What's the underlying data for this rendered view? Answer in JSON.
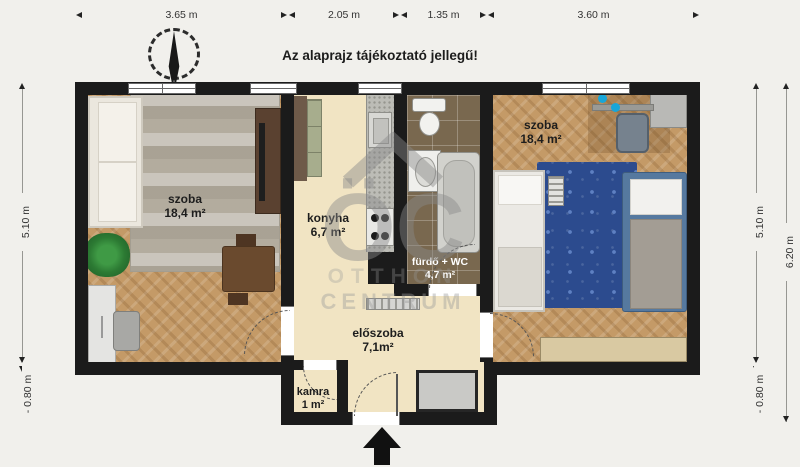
{
  "title": "Az alaprajz tájékoztató jellegű!",
  "dimensions": {
    "top": [
      {
        "label": "3.65 m"
      },
      {
        "label": "2.05 m"
      },
      {
        "label": "1.35 m"
      },
      {
        "label": "3.60 m"
      }
    ],
    "left": {
      "height": "5.10 m",
      "offset": "- 0.80 m"
    },
    "right_inner": {
      "height": "5.10 m",
      "offset": "- 0.80 m"
    },
    "right_outer": {
      "height": "6.20 m"
    }
  },
  "rooms": {
    "living_room": {
      "name": "szoba",
      "area": "18,4 m²"
    },
    "kitchen": {
      "name": "konyha",
      "area": "6,7 m²"
    },
    "bathroom": {
      "name": "fürdő + WC",
      "area": "4,7 m²"
    },
    "bedroom": {
      "name": "szoba",
      "area": "18,4 m²"
    },
    "hallway": {
      "name": "előszoba",
      "area": "7,1m²"
    },
    "pantry": {
      "name": "kamra",
      "area": "1 m²"
    }
  },
  "watermark": {
    "monogram": "ÖC",
    "line1": "OTTHON",
    "line2": "CENTRUM"
  },
  "icons": [
    "north-arrow-icon",
    "entrance-arrow-icon"
  ],
  "colors": {
    "background": "#f1f0ec",
    "wall": "#1b1b1b",
    "wood_floor": "#c49a67",
    "cream_floor": "#f1e4c3",
    "tile_floor": "#79684f",
    "rug_gray": "#b5afa2",
    "rug_blue": "#2c4b8e",
    "watermark_gray": "#8a8a8a"
  }
}
